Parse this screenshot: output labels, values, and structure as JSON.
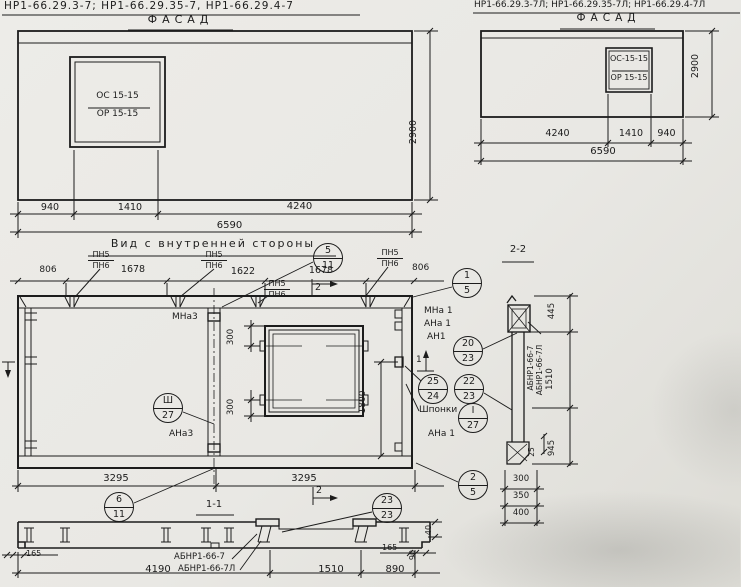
{
  "colors": {
    "paper": "#e9e8e4",
    "ink": "#1c1c1c"
  },
  "facade_left": {
    "title": "НР1-66.29.3-7;  НР1-66.29.35-7,  НР1-66.29.4-7",
    "view_label": "ФАСАД",
    "window_mark_top": "ОС 15-15",
    "window_mark_bottom": "ОР 15-15",
    "dim_940": "940",
    "dim_1410": "1410",
    "dim_4240": "4240",
    "dim_total": "6590",
    "dim_height": "2900"
  },
  "facade_right": {
    "title": "НР1-66.29.3-7Л; НР1-66.29.35-7Л; НР1-66.29.4-7Л",
    "view_label": "ФАСАД",
    "window_mark_top": "ОС-15-15",
    "window_mark_bottom": "ОР 15-15",
    "dim_4240": "4240",
    "dim_1410": "1410",
    "dim_940": "940",
    "dim_total": "6590",
    "dim_height": "2900"
  },
  "inner_view": {
    "title": "Вид с внутренней стороны",
    "pn_top": "ПН5",
    "pn_bottom": "ПН6",
    "dim_806": "806",
    "dim_1678": "1678",
    "dim_1622": "1622",
    "dim_300": "300",
    "dim_1800": "1800",
    "dim_3295": "3295",
    "label_mna3": "МНа3",
    "label_ana3": "АНа3",
    "label_mna1": "МНа 1",
    "label_ana1": "АНа 1",
    "label_an1": "АН1",
    "label_shponki": "Шпонки",
    "label_ana1_bottom": "АНа 1",
    "section_mark_1": "1",
    "section_mark_2": "2",
    "callout_5_11": {
      "top": "5",
      "bottom": "11"
    },
    "callout_1_5": {
      "top": "1",
      "bottom": "5"
    },
    "callout_2_5": {
      "top": "2",
      "bottom": "5"
    },
    "callout_sh_27": {
      "top": "Ш",
      "bottom": "27"
    },
    "callout_20_23": {
      "top": "20",
      "bottom": "23"
    },
    "callout_25_24": {
      "top": "25",
      "bottom": "24"
    },
    "callout_22_23": {
      "top": "22",
      "bottom": "23"
    },
    "callout_1_27": {
      "top": "I",
      "bottom": "27"
    },
    "callout_6_11": {
      "top": "6",
      "bottom": "11"
    },
    "callout_23_23": {
      "top": "23",
      "bottom": "23"
    }
  },
  "section_1_1": {
    "title": "1-1",
    "mark": "АБНР1-66-7",
    "mark_l": "АБНР1-66-7Л",
    "dim_90": "90",
    "dim_165": "165",
    "dim_40": "40",
    "dim_4190": "4190",
    "dim_1510": "1510",
    "dim_890": "890"
  },
  "section_2_2": {
    "title": "2-2",
    "mark": "АБНР1-66-7",
    "mark_l": "АБНР1-66-7Л",
    "dim_445": "445",
    "dim_1510": "1510",
    "dim_945": "945",
    "dim_25": "25",
    "dim_300": "300",
    "dim_350": "350",
    "dim_400": "400"
  }
}
